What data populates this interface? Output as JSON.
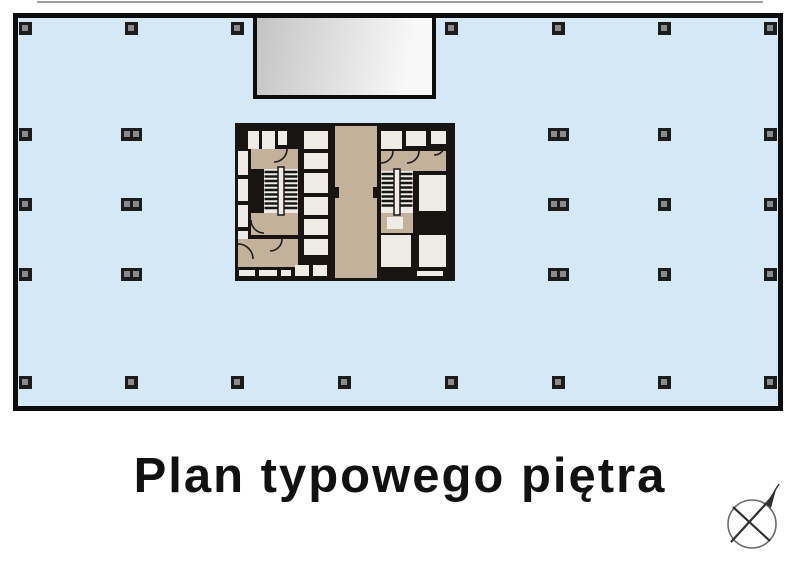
{
  "title": {
    "text": "Plan typowego piętra"
  },
  "colors": {
    "page_bg": "#ffffff",
    "top_line": "#8f8f8f",
    "floor_fill": "#d5e8f6",
    "plan_border": "#0d0d0d",
    "column_frame": "#1c1c1c",
    "column_inner": "#8a8a8a",
    "shaft_from": "#c4c4c4",
    "shaft_to": "#f8f8f8",
    "core_wall": "#171411",
    "room_white": "#efece6",
    "room_tan": "#c3b19c",
    "stair_tread": "#161616",
    "door_arc": "#1c1c1c",
    "title_color": "#111111",
    "compass_line": "#2f2f2f",
    "compass_circle": "#6a6a6a"
  }
}
